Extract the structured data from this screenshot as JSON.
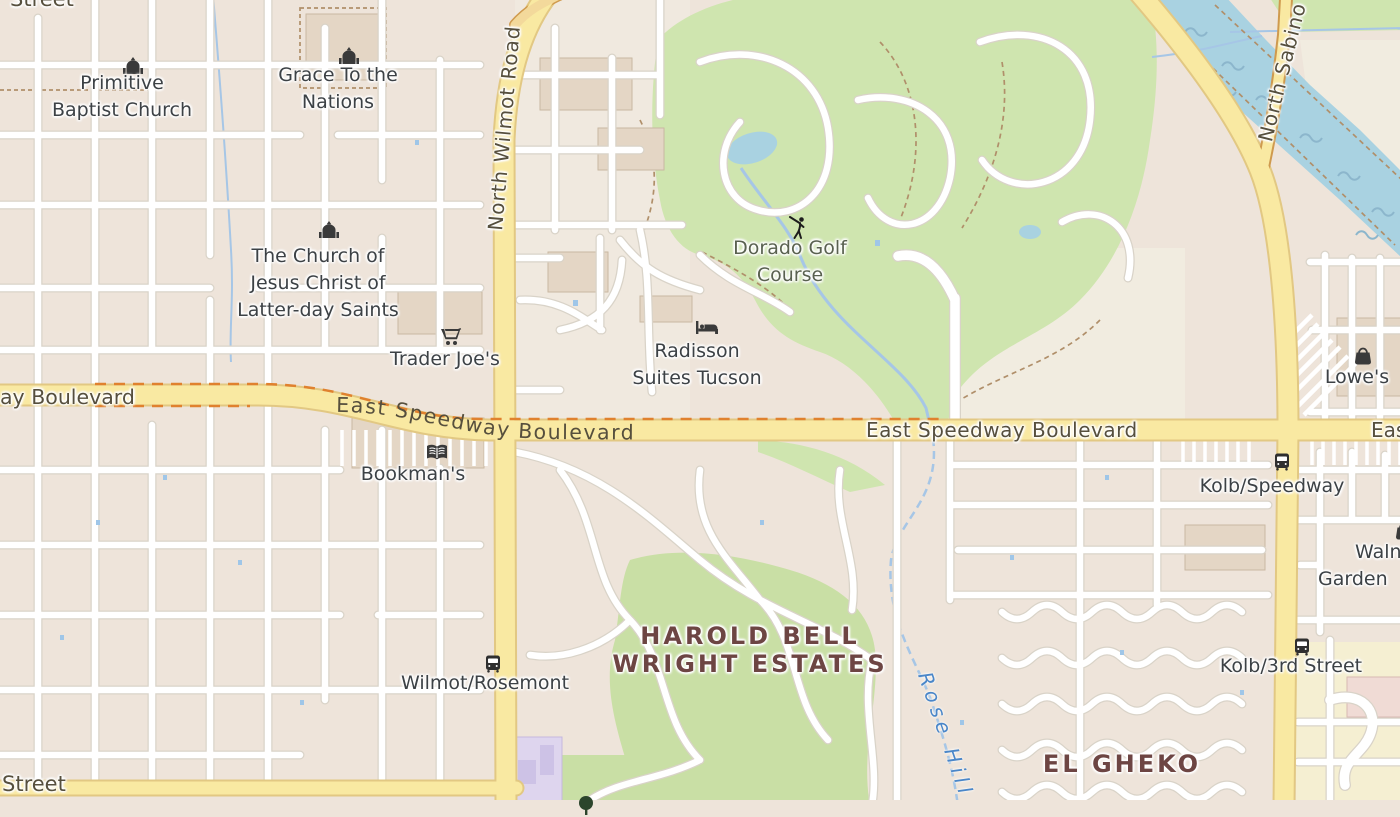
{
  "map": {
    "type": "street-map-tile-view",
    "districts": {
      "harold_bell_wright": {
        "line1": "HAROLD BELL",
        "line2": "WRIGHT ESTATES"
      },
      "el_gheko": {
        "line1": "EL GHEKO"
      }
    },
    "roads": {
      "speedway_label_left_clip": "ay Boulevard",
      "speedway_curved": "East Speedway Boulevard",
      "speedway_center": "East Speedway Boulevard",
      "speedway_right_clip": "East Speedw",
      "wilmot": "North Wilmot Road",
      "sabino": "North Sabino",
      "street_top": "Street",
      "street_bottom": "Street"
    },
    "water": {
      "wash_label": "Rose Hill"
    },
    "pois": [
      {
        "name": "primitive-baptist-church",
        "icon": "church-icon",
        "lines": [
          "Primitive",
          "Baptist Church"
        ]
      },
      {
        "name": "grace-to-the-nations",
        "icon": "church-icon",
        "lines": [
          "Grace To the",
          "Nations"
        ]
      },
      {
        "name": "lds-church",
        "icon": "church-icon",
        "lines": [
          "The Church of",
          "Jesus Christ of",
          "Latter-day Saints"
        ]
      },
      {
        "name": "trader-joes",
        "icon": "cart-icon",
        "lines": [
          "Trader Joe's"
        ]
      },
      {
        "name": "bookmans",
        "icon": "book-icon",
        "lines": [
          "Bookman's"
        ]
      },
      {
        "name": "dorado-golf-course",
        "icon": "golfer-icon",
        "lines": [
          "Dorado Golf",
          "Course"
        ]
      },
      {
        "name": "radisson-suites-tucson",
        "icon": "bed-icon",
        "lines": [
          "Radisson",
          "Suites Tucson"
        ]
      },
      {
        "name": "lowes",
        "icon": "bag-icon",
        "lines": [
          "Lowe's"
        ]
      },
      {
        "name": "walnut-garden",
        "icon": "bag-icon",
        "lines": [
          "Walnut",
          "Garden"
        ]
      },
      {
        "name": "kolb-speedway-bus-stop",
        "icon": "bus-icon",
        "lines": [
          "Kolb/Speedway"
        ]
      },
      {
        "name": "wilmot-rosemont-bus-stop",
        "icon": "bus-icon",
        "lines": [
          "Wilmot/Rosemont"
        ]
      },
      {
        "name": "kolb-3rd-street-bus-stop",
        "icon": "bus-icon",
        "lines": [
          "Kolb/3rd Street"
        ]
      }
    ],
    "colors": {
      "base": "#eee4da",
      "open_land": "#f1ece0",
      "golf_green": "#cfe5af",
      "park_green": "#c9dfa5",
      "water": "#a9d2e1",
      "water_wave": "#8cb6cc",
      "stream": "#a6c6e6",
      "road_fill": "#f9e9a2",
      "road_casing": "#e2c883",
      "sabino_casing": "#cf9a4e",
      "minor_road_casing": "#d9d3c8",
      "minor_road_fill": "#ffffff",
      "building": "#e4d6c5",
      "school_purple": "#ded5ee",
      "school_yellow": "#f5efd2",
      "construction_dash": "#e0812e",
      "trail_dash": "#b08f6a",
      "poi_label": "#3c4145",
      "road_label": "#564f3d",
      "district_label": "#6d4543",
      "water_label": "#4a86c8",
      "icon_color": "#3a3a3a"
    }
  }
}
